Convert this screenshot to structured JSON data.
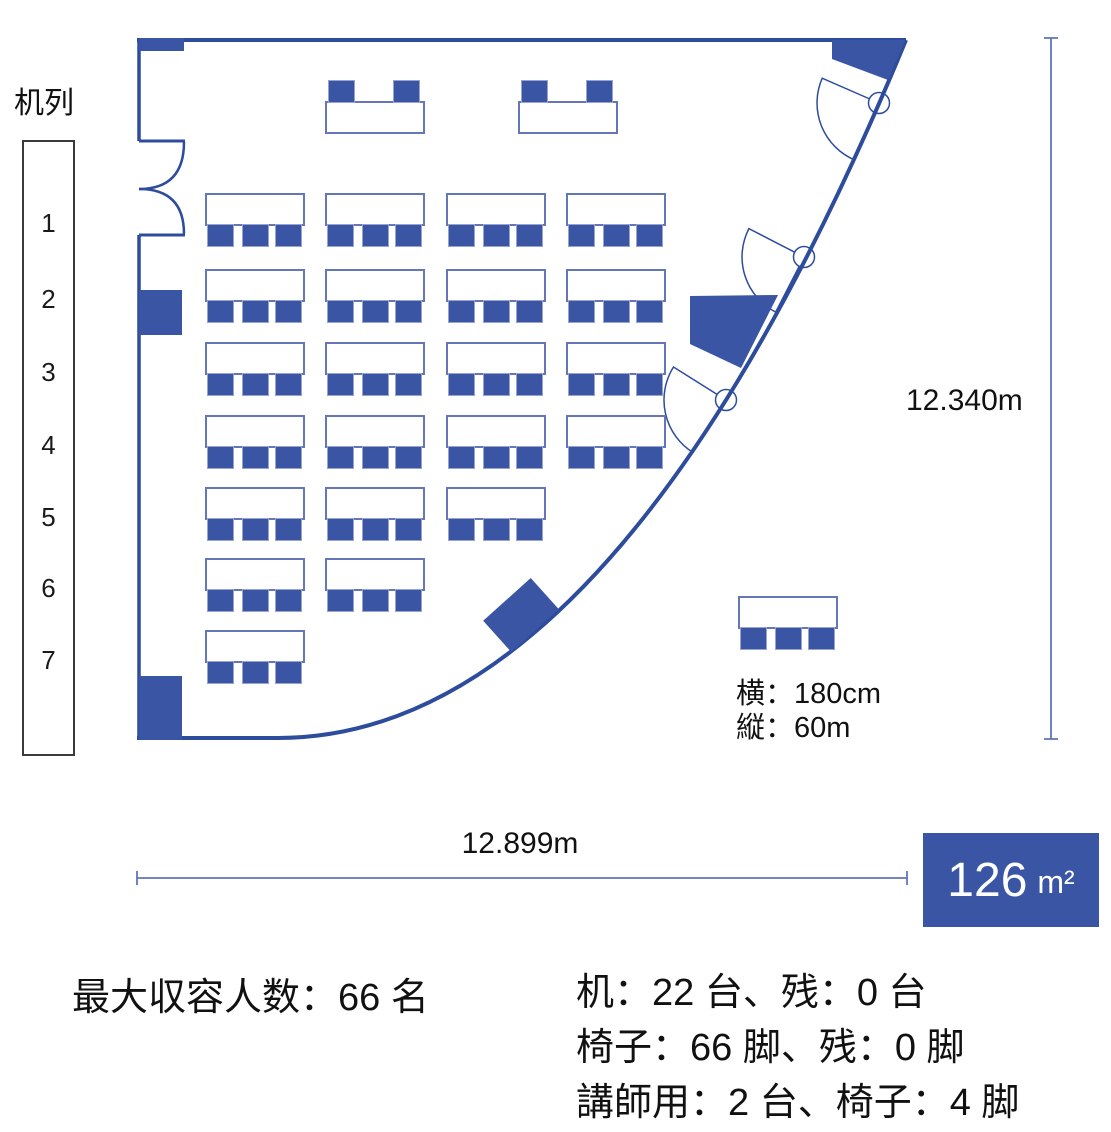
{
  "sidebar": {
    "title": "机列",
    "rows": [
      "1",
      "2",
      "3",
      "4",
      "5",
      "6",
      "7"
    ]
  },
  "dimensions": {
    "height_label": "12.340m",
    "width_label": "12.899m"
  },
  "legend": {
    "width_label": "横：180cm",
    "depth_label": "縦：60m"
  },
  "area_badge": {
    "value": "126",
    "unit": "m²"
  },
  "stats": {
    "capacity": "最大収容人数：66 名",
    "lines": [
      "机：22 台、残：0 台",
      "椅子：66 脚、残：0 脚",
      "講師用：2 台、椅子：4 脚"
    ]
  },
  "floorplan": {
    "desk_rows_counts": [
      4,
      4,
      4,
      4,
      3,
      2,
      1
    ],
    "chairs_per_desk": 3,
    "lecturer_desk_count": 2,
    "chairs_per_lecturer_desk": 2,
    "legend_desk_chairs": 3
  },
  "colors": {
    "primary": "#3a55a4",
    "wall": "#2d4c9c",
    "dim": "#6074b8",
    "table-border": "#6577b8",
    "chair-border": "#98a3d0",
    "badge-bg": "#3a55a4",
    "badge-text": "#ffffff"
  }
}
